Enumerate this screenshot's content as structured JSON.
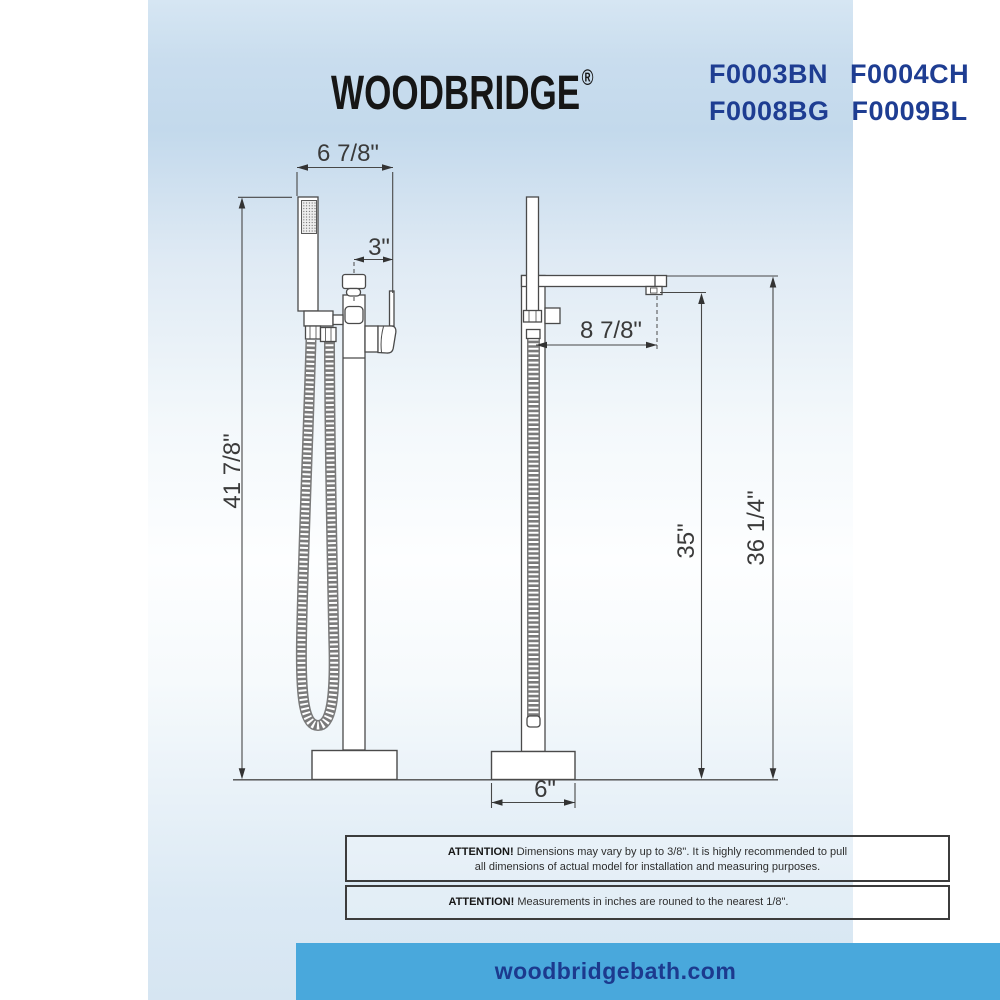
{
  "header": {
    "brand": "WOODBRIDGE",
    "registered_mark": "®",
    "model_lines": [
      "F0003BN F0004CH",
      "F0008BG F0009BL"
    ]
  },
  "diagram": {
    "front_view": {
      "width_top": "6 7/8\"",
      "handle_offset": "3\"",
      "overall_height": "41 7/8\""
    },
    "side_view": {
      "spout_reach": "8 7/8\"",
      "spout_height": "35\"",
      "spout_top_height": "36 1/4\"",
      "base_width": "6\""
    }
  },
  "notices": [
    {
      "label": "ATTENTION!",
      "line1": "Dimensions may vary by up to 3/8\". It is highly recommended to pull",
      "line2": "all dimensions of actual model for installation and measuring purposes."
    },
    {
      "label": "ATTENTION!",
      "line1": "Measurements in inches are rouned to the nearest 1/8\"."
    }
  ],
  "footer": {
    "website": "woodbridgebath.com"
  },
  "colors": {
    "footer_blue": "#49a8dc",
    "model_navy": "#1e3d92",
    "banner_text_navy": "#1c3a8e",
    "line_gray": "#4a4a4a"
  }
}
